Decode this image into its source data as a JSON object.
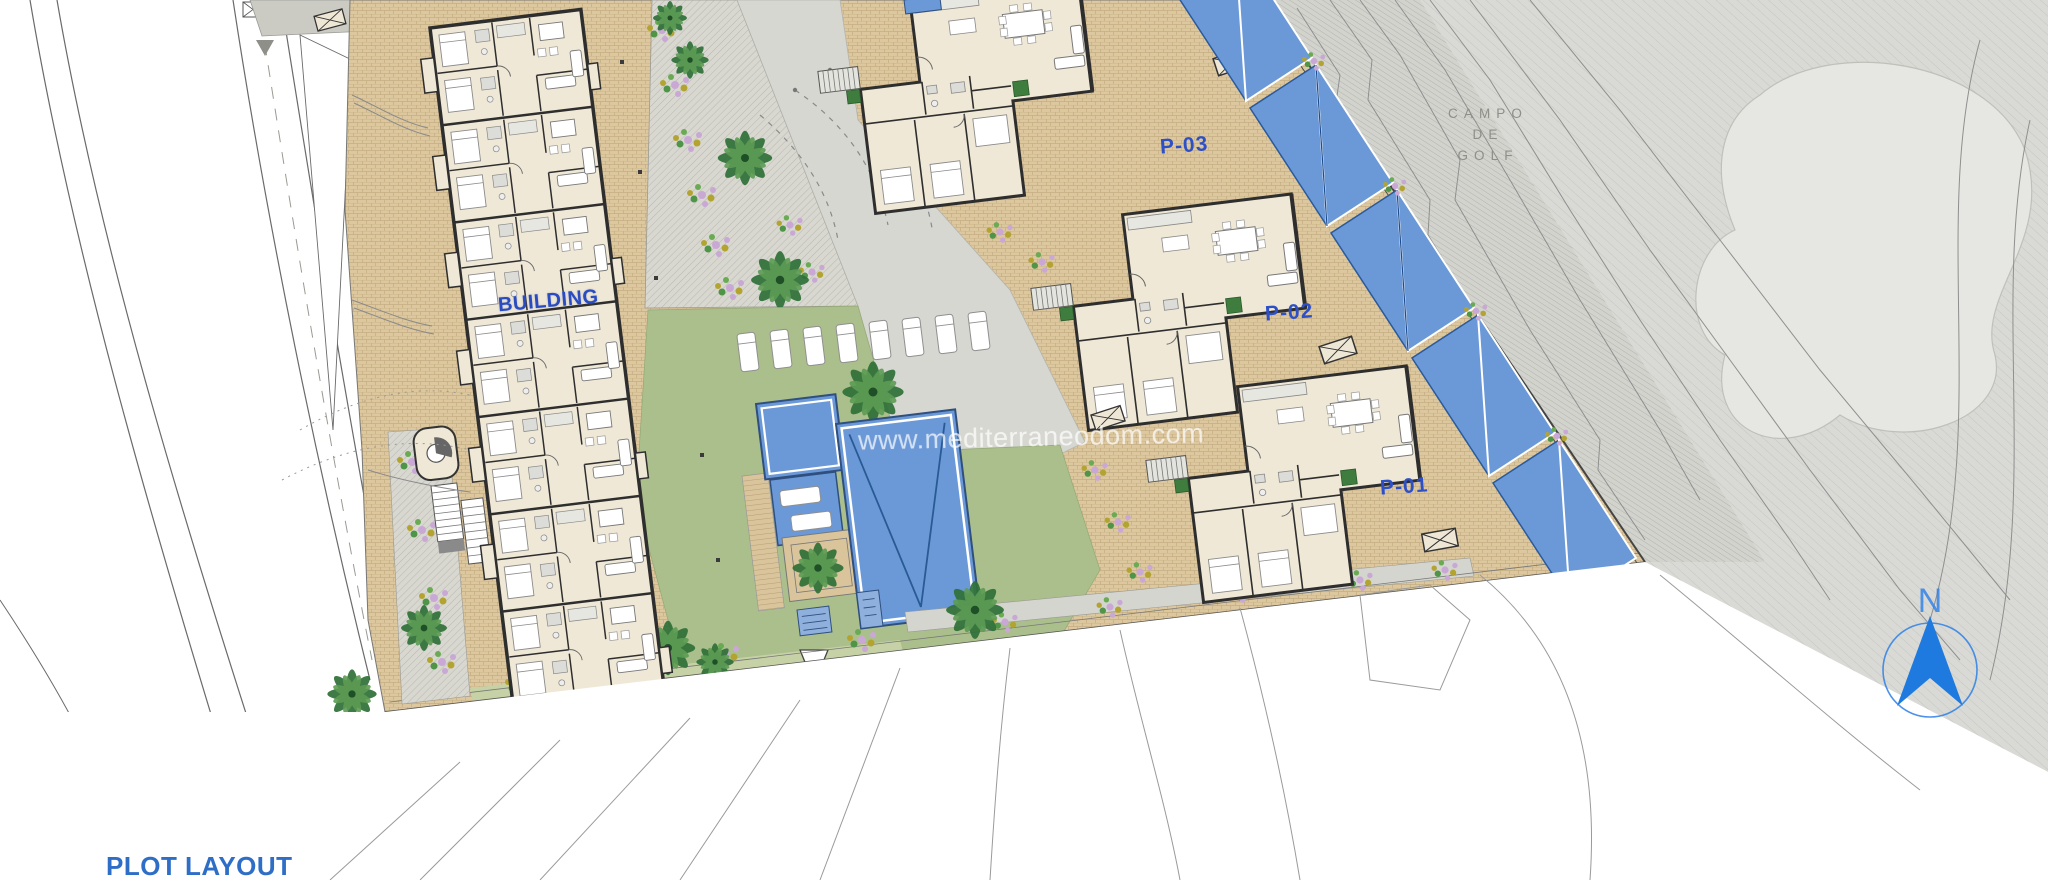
{
  "plan": {
    "building_label": "BUILDING",
    "villas": {
      "p01": "P-01",
      "p02": "P-02",
      "p03": "P-03"
    },
    "golf_label": {
      "line1": "CAMPO",
      "line2": "DE",
      "line3": "GOLF"
    },
    "title": "PLOT LAYOUT",
    "watermark": "www.mediterraneodom.com",
    "compass_letter": "N",
    "colors": {
      "label_blue": "#2e50c6",
      "title_blue": "#2e6ec6",
      "compass_blue": "#2b7fe8",
      "pool_blue": "#6b99d8",
      "paving_tan": "#dcc79f",
      "lawn_green": "#abbf8c",
      "golf_gray": "#d9d9d5",
      "interior_cream": "#efe8d6"
    }
  }
}
